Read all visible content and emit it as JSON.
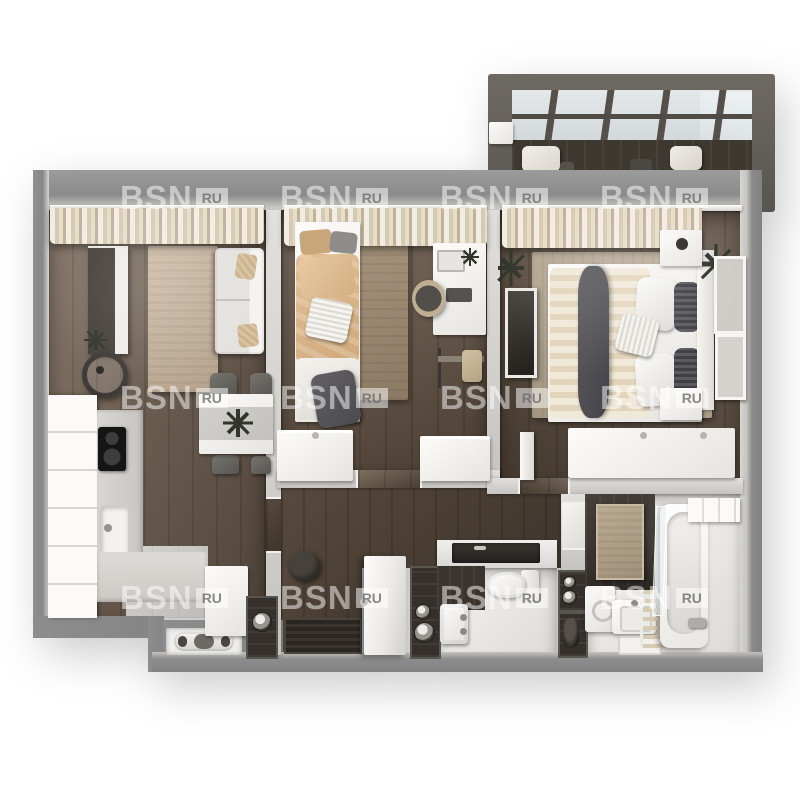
{
  "watermark": {
    "brand": "BSN",
    "suffix": "RU"
  },
  "scene": {
    "type": "apartment-3d-floor-plan-top-view",
    "rooms": [
      "living-room-with-kitchen",
      "bedroom",
      "master-bedroom",
      "hallway",
      "wc",
      "bathroom",
      "glazed-balcony"
    ]
  },
  "palette": {
    "outer_wall": "#8d8d8d",
    "interior_wall": "#d6d4d1",
    "wood_floor": "#6b5d50",
    "hall_floor": "#4a3f35",
    "kitchen_tile": "#c9c7c3",
    "wet_room_floor": "#efeeec",
    "dark_feature": "#35302b",
    "rug_living": "#c4b19b",
    "rug_bedroom": "#9a8871",
    "rug_master": "#b3a693",
    "bedding_beige": "#dfbd92",
    "textile_dark": "#57565a",
    "furniture_white": "#f4f3f0",
    "balcony_frame": "#5f5a54",
    "glass": "#e9eef0"
  }
}
